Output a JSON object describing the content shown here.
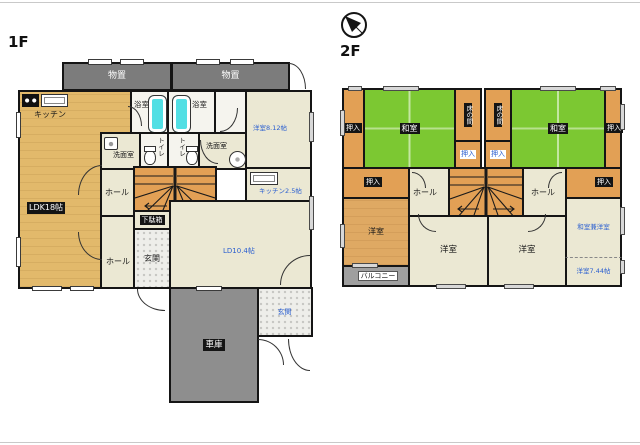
{
  "colors": {
    "wall": "#151515",
    "tatami_green": "#7cc832",
    "floor_tan": "#e2b96b",
    "floor_cream": "#ebe8d3",
    "floor_orange": "#e2a055",
    "storage_gray": "#7c7c7c",
    "garage_gray": "#8e8e8e",
    "balcony_gray": "#9f9f9f",
    "tub_cyan": "#52dfe4",
    "size_label_blue": "#2b5fd0"
  },
  "floor1": {
    "title": "1F",
    "labels": {
      "storage_left": "物置",
      "storage_right": "物置",
      "kitchen": "キッチン",
      "bath_left": "浴室",
      "bath_right": "浴室",
      "washroom_left": "洗面室",
      "washroom_right": "洗面室",
      "toilet_left": "トイレ",
      "toilet_right": "トイレ",
      "hall_upper": "ホール",
      "hall_lower": "ホール",
      "ldk": "LDK18帖",
      "shoe_cabinet": "下駄箱",
      "entrance_left": "玄関",
      "entrance_right": "玄関",
      "western_room": "洋室8.12帖",
      "kitchen_size": "キッチン2.5帖",
      "living_dining": "LD10.4帖",
      "garage": "車庫"
    }
  },
  "floor2": {
    "title": "2F",
    "labels": {
      "closet_edge_left": "押入",
      "closet_edge_right": "押入",
      "tatami_left": "和室",
      "tatami_right": "和室",
      "tokonoma_left": "床の間",
      "tokonoma_right": "床の間",
      "closet_center_left": "押入",
      "closet_center_right": "押入",
      "closet_mid_left": "押入",
      "closet_mid_right": "押入",
      "hall_left": "ホール",
      "hall_right": "ホール",
      "western_left": "洋室",
      "western_center_left": "洋室",
      "western_center_right": "洋室",
      "tatami_western": "和室兼洋室",
      "western_small": "洋室7.44帖",
      "balcony": "バルコニー"
    }
  }
}
